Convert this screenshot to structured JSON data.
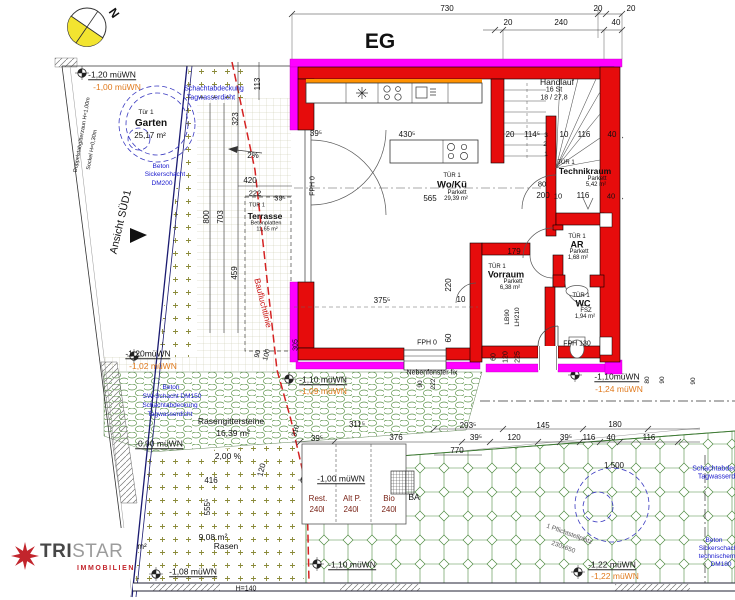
{
  "meta": {
    "title": "EG",
    "north": "N"
  },
  "logo": {
    "tri": "TRI",
    "star": "STAR",
    "sub": "IMMOBILIEN"
  },
  "palette": {
    "wall_red": "#e60c0c",
    "band_magenta": "#ff00ff",
    "accent_orange": "#ff9100",
    "level_orange": "#e07a1e",
    "annotation_blue": "#1818cc",
    "bauflucht_red": "#d42222",
    "pattern_green": "#4d8a40",
    "compass_yellow": "#f2e430",
    "logo_red": "#c2252c"
  },
  "labels": [
    {
      "n": "dim-730",
      "t": "730",
      "x": 447,
      "y": 9
    },
    {
      "n": "dim-20-top-a",
      "t": "20",
      "x": 598,
      "y": 9
    },
    {
      "n": "dim-20-top-b",
      "t": "20",
      "x": 631,
      "y": 9
    },
    {
      "n": "dim-20-top-c",
      "t": "20",
      "x": 508,
      "y": 23
    },
    {
      "n": "dim-240",
      "t": "240",
      "x": 561,
      "y": 23
    },
    {
      "n": "dim-40-top",
      "t": "40",
      "x": 616,
      "y": 23
    },
    {
      "n": "dim-39-entry",
      "t": "39⁵",
      "x": 316,
      "y": 134
    },
    {
      "n": "dim-430",
      "t": "430⁵",
      "x": 407,
      "y": 135
    },
    {
      "n": "dim-20-stair",
      "t": "20",
      "x": 510,
      "y": 135
    },
    {
      "n": "dim-114",
      "t": "114⁵",
      "x": 532,
      "y": 135
    },
    {
      "n": "stair-step-3",
      "t": "3",
      "x": 546,
      "y": 136,
      "fs": 6.5
    },
    {
      "n": "dim-10-stair",
      "t": "10",
      "x": 564,
      "y": 135
    },
    {
      "n": "dim-116-stair",
      "t": "116",
      "x": 584,
      "y": 135
    },
    {
      "n": "dim-40-stair",
      "t": "40",
      "x": 612,
      "y": 135
    },
    {
      "n": "dim-80-tech",
      "t": "80",
      "x": 542,
      "y": 184,
      "fs": 7.5
    },
    {
      "n": "dim-200-tech",
      "t": "200",
      "x": 543,
      "y": 196
    },
    {
      "n": "dim-10-tech",
      "t": "10",
      "x": 558,
      "y": 196,
      "fs": 7.5
    },
    {
      "n": "dim-116-tech",
      "t": "116",
      "x": 583,
      "y": 196
    },
    {
      "n": "dim-40-tech",
      "t": "40",
      "x": 611,
      "y": 196,
      "fs": 7.5
    },
    {
      "n": "stair-step-1",
      "t": "1",
      "x": 546,
      "y": 155,
      "fs": 6.5
    },
    {
      "n": "stair-step-2",
      "t": "2",
      "x": 545,
      "y": 145,
      "fs": 6.5
    },
    {
      "n": "dim-565",
      "t": "565",
      "x": 430,
      "y": 199
    },
    {
      "n": "dim-179",
      "t": "179",
      "x": 514,
      "y": 252
    },
    {
      "n": "dim-220",
      "t": "220",
      "x": 449,
      "y": 285,
      "r": -90
    },
    {
      "n": "dim-375",
      "t": "375⁵",
      "x": 382,
      "y": 301
    },
    {
      "n": "dim-10-wk",
      "t": "10",
      "x": 461,
      "y": 300
    },
    {
      "n": "dim-60-wk",
      "t": "60",
      "x": 449,
      "y": 338,
      "r": -90
    },
    {
      "n": "label-fph0-a",
      "t": "FPH 0",
      "x": 427,
      "y": 343,
      "fs": 7
    },
    {
      "n": "label-fph0-b",
      "t": "FPH 0",
      "x": 313,
      "y": 186,
      "r": -90,
      "fs": 7
    },
    {
      "n": "dim-800",
      "t": "800",
      "x": 207,
      "y": 217,
      "r": -90
    },
    {
      "n": "dim-703",
      "t": "703",
      "x": 221,
      "y": 217,
      "r": -90
    },
    {
      "n": "dim-459",
      "t": "459",
      "x": 235,
      "y": 273,
      "r": -90
    },
    {
      "n": "dim-323",
      "t": "323",
      "x": 236,
      "y": 119,
      "r": -90
    },
    {
      "n": "dim-113",
      "t": "113",
      "x": 258,
      "y": 84,
      "r": -90
    },
    {
      "n": "dim-305",
      "t": "305",
      "x": 296,
      "y": 345,
      "r": -90,
      "fs": 7
    },
    {
      "n": "dim-420",
      "t": "420",
      "x": 250,
      "y": 181
    },
    {
      "n": "dim-222-terr",
      "t": "222",
      "x": 255,
      "y": 193,
      "fs": 7.5
    },
    {
      "n": "dim-39-terr",
      "t": "39⁵",
      "x": 280,
      "y": 198,
      "fs": 7.5
    },
    {
      "n": "dim-90-terr",
      "t": "90",
      "x": 258,
      "y": 354,
      "r": -75,
      "fs": 7
    },
    {
      "n": "dim-100-terr",
      "t": "100",
      "x": 267,
      "y": 355,
      "r": -75,
      "fs": 7
    },
    {
      "n": "dim-60-entry",
      "t": "60",
      "x": 494,
      "y": 357,
      "r": -90,
      "fs": 7
    },
    {
      "n": "dim-120-entry",
      "t": "120",
      "x": 506,
      "y": 357,
      "r": -90,
      "fs": 7
    },
    {
      "n": "dim-225-entry",
      "t": "225",
      "x": 518,
      "y": 357,
      "r": -90,
      "fs": 7
    },
    {
      "n": "label-lb90",
      "t": "LB90",
      "x": 508,
      "y": 317,
      "r": -90,
      "fs": 6.5
    },
    {
      "n": "label-lh210",
      "t": "LH210",
      "x": 518,
      "y": 317,
      "r": -90,
      "fs": 6.5
    },
    {
      "n": "label-fph130",
      "t": "FPH 130",
      "x": 577,
      "y": 344,
      "fs": 7
    },
    {
      "n": "dim-90-window",
      "t": "90",
      "x": 421,
      "y": 384,
      "r": -90,
      "fs": 6.5
    },
    {
      "n": "dim-222-window",
      "t": "222",
      "x": 434,
      "y": 384,
      "r": -90,
      "fs": 6.5
    },
    {
      "n": "dim-80-right",
      "t": "80",
      "x": 648,
      "y": 380,
      "r": -90,
      "fs": 6.5
    },
    {
      "n": "dim-90-right-a",
      "t": "90",
      "x": 663,
      "y": 380,
      "r": -90,
      "fs": 6.5
    },
    {
      "n": "dim-90-right-b",
      "t": "90",
      "x": 694,
      "y": 381,
      "r": -90,
      "fs": 6.5
    },
    {
      "n": "dim-310",
      "t": "310",
      "x": 296,
      "y": 431,
      "r": -75,
      "fs": 7
    },
    {
      "n": "dim-311",
      "t": "311⁵",
      "x": 357,
      "y": 425
    },
    {
      "n": "dim-203",
      "t": "203⁵",
      "x": 468,
      "y": 426
    },
    {
      "n": "dim-145",
      "t": "145",
      "x": 543,
      "y": 426
    },
    {
      "n": "dim-180",
      "t": "180",
      "x": 615,
      "y": 425
    },
    {
      "n": "dim-39-row-a",
      "t": "39⁵",
      "x": 317,
      "y": 439
    },
    {
      "n": "dim-376",
      "t": "376",
      "x": 396,
      "y": 438
    },
    {
      "n": "dim-39-row-b",
      "t": "39⁵",
      "x": 476,
      "y": 438
    },
    {
      "n": "dim-120-row",
      "t": "120",
      "x": 514,
      "y": 438
    },
    {
      "n": "dim-39-row-c",
      "t": "39⁵",
      "x": 566,
      "y": 438
    },
    {
      "n": "dim-116-row-a",
      "t": "116",
      "x": 589,
      "y": 438
    },
    {
      "n": "dim-40-row",
      "t": "40",
      "x": 611,
      "y": 438
    },
    {
      "n": "dim-116-row-b",
      "t": "116",
      "x": 649,
      "y": 438
    },
    {
      "n": "dim-770",
      "t": "770",
      "x": 457,
      "y": 451
    },
    {
      "n": "dim-1500",
      "t": "1 500",
      "x": 614,
      "y": 466
    },
    {
      "n": "dim-416",
      "t": "416",
      "x": 211,
      "y": 481
    },
    {
      "n": "dim-120-lawn",
      "t": "120",
      "x": 262,
      "y": 470,
      "r": -75
    },
    {
      "n": "dim-555",
      "t": "555⁵",
      "x": 208,
      "y": 507,
      "r": -90
    },
    {
      "n": "label-h140",
      "t": "H=140",
      "x": 246,
      "y": 589,
      "fs": 7
    },
    {
      "n": "slope-2pct",
      "t": "2%",
      "x": 253,
      "y": 156
    },
    {
      "n": "slope-200pct",
      "t": "2,00 %",
      "x": 228,
      "y": 456,
      "fs": 8.5
    },
    {
      "n": "room-woku-tuer",
      "t": "TÜR 1",
      "x": 452,
      "y": 176,
      "fs": 6
    },
    {
      "n": "room-woku-name",
      "t": "Wo/Kü",
      "x": 452,
      "y": 185,
      "fs": 9.5,
      "b": 1
    },
    {
      "n": "room-woku-floor",
      "t": "Parkett",
      "x": 457,
      "y": 193,
      "fs": 6
    },
    {
      "n": "room-woku-area",
      "t": "29,39 m²",
      "x": 456,
      "y": 199,
      "fs": 6
    },
    {
      "n": "room-technik-tuer",
      "t": "TÜR 1",
      "x": 566,
      "y": 163,
      "fs": 6
    },
    {
      "n": "room-technik-name",
      "t": "Technikraum",
      "x": 585,
      "y": 171,
      "fs": 8.5,
      "b": 1
    },
    {
      "n": "room-technik-floor",
      "t": "Parkett",
      "x": 597,
      "y": 179,
      "fs": 6
    },
    {
      "n": "room-technik-area",
      "t": "5,42 m²",
      "x": 596,
      "y": 185,
      "fs": 6
    },
    {
      "n": "room-ar-tuer",
      "t": "TÜR 1",
      "x": 577,
      "y": 237,
      "fs": 6
    },
    {
      "n": "room-ar-name",
      "t": "AR",
      "x": 577,
      "y": 245,
      "fs": 9,
      "b": 1
    },
    {
      "n": "room-ar-floor",
      "t": "Parkett",
      "x": 579,
      "y": 252,
      "fs": 6
    },
    {
      "n": "room-ar-area",
      "t": "1,68 m²",
      "x": 578,
      "y": 258,
      "fs": 6
    },
    {
      "n": "room-vorraum-tuer",
      "t": "TÜR 1",
      "x": 497,
      "y": 267,
      "fs": 6
    },
    {
      "n": "room-vorraum-name",
      "t": "Vorraum",
      "x": 506,
      "y": 275,
      "fs": 9,
      "b": 1
    },
    {
      "n": "room-vorraum-floor",
      "t": "Parkett",
      "x": 513,
      "y": 282,
      "fs": 6
    },
    {
      "n": "room-vorraum-area",
      "t": "6,38 m²",
      "x": 510,
      "y": 288,
      "fs": 6
    },
    {
      "n": "room-wc-tuer",
      "t": "TÜR 1",
      "x": 581,
      "y": 296,
      "fs": 6
    },
    {
      "n": "room-wc-name",
      "t": "WC",
      "x": 583,
      "y": 304,
      "fs": 9,
      "b": 1
    },
    {
      "n": "room-wc-floor",
      "t": "FSZ",
      "x": 586,
      "y": 311,
      "fs": 6
    },
    {
      "n": "room-wc-area",
      "t": "1,94 m²",
      "x": 585,
      "y": 317,
      "fs": 6
    },
    {
      "n": "stair-handlauf",
      "t": "Handlauf",
      "x": 557,
      "y": 82,
      "fs": 8.5
    },
    {
      "n": "stair-count",
      "t": "16 St",
      "x": 554,
      "y": 90,
      "fs": 7
    },
    {
      "n": "stair-ratio",
      "t": "18 / 27,8",
      "x": 554,
      "y": 98,
      "fs": 7
    },
    {
      "n": "area-garten-tuer",
      "t": "Tür 1",
      "x": 146,
      "y": 113,
      "fs": 6.5
    },
    {
      "n": "area-garten-name",
      "t": "Garten",
      "x": 151,
      "y": 124,
      "fs": 10,
      "b": 1
    },
    {
      "n": "area-garten-size",
      "t": "25,17 m²",
      "x": 150,
      "y": 136,
      "fs": 8
    },
    {
      "n": "area-terrasse-tuer",
      "t": "TÜR 1",
      "x": 257,
      "y": 206,
      "fs": 5.5
    },
    {
      "n": "area-terrasse-name",
      "t": "Terrasse",
      "x": 265,
      "y": 216,
      "fs": 8.5,
      "b": 1
    },
    {
      "n": "area-terrasse-floor",
      "t": "Betonplatten",
      "x": 266,
      "y": 224,
      "fs": 5.5
    },
    {
      "n": "area-terrasse-size",
      "t": "11,65 m²",
      "x": 267,
      "y": 230,
      "fs": 5.5
    },
    {
      "n": "area-rasengitter-name",
      "t": "Rasengittersteine",
      "x": 231,
      "y": 421,
      "fs": 8.5
    },
    {
      "n": "area-rasengitter-size",
      "t": "16,39 m²",
      "x": 233,
      "y": 433,
      "fs": 8.5
    },
    {
      "n": "area-rasen-size",
      "t": "9,08 m²",
      "x": 213,
      "y": 537,
      "fs": 8.5
    },
    {
      "n": "area-rasen-name",
      "t": "Rasen",
      "x": 226,
      "y": 546,
      "fs": 8.5
    },
    {
      "n": "stray-m2",
      "t": "m²",
      "x": 142,
      "y": 547,
      "fs": 8
    },
    {
      "n": "bin-rest-name",
      "t": "Rest.",
      "x": 318,
      "y": 499,
      "col": "#7a2418"
    },
    {
      "n": "bin-rest-vol",
      "t": "240l",
      "x": 317,
      "y": 510,
      "col": "#7a2418"
    },
    {
      "n": "bin-altp-name",
      "t": "Alt P.",
      "x": 352,
      "y": 499,
      "col": "#7a2418"
    },
    {
      "n": "bin-altp-vol",
      "t": "240l",
      "x": 351,
      "y": 510,
      "col": "#7a2418"
    },
    {
      "n": "bin-bio-name",
      "t": "Bio",
      "x": 389,
      "y": 499,
      "col": "#7a2418"
    },
    {
      "n": "bin-bio-vol",
      "t": "240l",
      "x": 389,
      "y": 510,
      "col": "#7a2418"
    },
    {
      "n": "label-ba",
      "t": "BA",
      "x": 414,
      "y": 497,
      "fs": 8.5
    },
    {
      "n": "stellplatz-line1",
      "t": "1 Pflichtstellplatz",
      "x": 569,
      "y": 535,
      "fs": 6.5,
      "col": "#555555",
      "r": 20
    },
    {
      "n": "stellplatz-line2",
      "t": "230x650",
      "x": 563,
      "y": 548,
      "fs": 6.5,
      "col": "#555555",
      "r": 20
    },
    {
      "n": "schacht-tl-1",
      "t": "Schachtabdeckung",
      "x": 214,
      "y": 89,
      "fs": 7,
      "col": "#1818cc"
    },
    {
      "n": "schacht-tl-2",
      "t": "Tagwasserdicht",
      "x": 211,
      "y": 98,
      "fs": 7,
      "col": "#1818cc"
    },
    {
      "n": "sicker-tl-1",
      "t": "Beton",
      "x": 161,
      "y": 167,
      "fs": 6.5,
      "col": "#1818cc"
    },
    {
      "n": "sicker-tl-2",
      "t": "Sickerschacht",
      "x": 165,
      "y": 175,
      "fs": 6.5,
      "col": "#1818cc"
    },
    {
      "n": "sicker-tl-3",
      "t": "DM200",
      "x": 162,
      "y": 184,
      "fs": 6.5,
      "col": "#1818cc"
    },
    {
      "n": "sw-schacht-1",
      "t": "Beton",
      "x": 171,
      "y": 388,
      "fs": 6.5,
      "col": "#1818cc"
    },
    {
      "n": "sw-schacht-2",
      "t": "SW-Schacht DM150",
      "x": 172,
      "y": 397,
      "fs": 6.5,
      "col": "#1818cc"
    },
    {
      "n": "sw-schacht-3",
      "t": "Schachtabdeckung",
      "x": 170,
      "y": 406,
      "fs": 6.5,
      "col": "#1818cc"
    },
    {
      "n": "sw-schacht-4",
      "t": "Tagwasserdicht",
      "x": 170,
      "y": 415,
      "fs": 6.5,
      "col": "#1818cc"
    },
    {
      "n": "schacht-br-1",
      "t": "Schachtabdeckung",
      "x": 722,
      "y": 469,
      "fs": 7,
      "col": "#1818cc"
    },
    {
      "n": "schacht-br-2",
      "t": "Tagwasserdicht",
      "x": 722,
      "y": 477,
      "fs": 7,
      "col": "#1818cc"
    },
    {
      "n": "sicker-br-1",
      "t": "Beton",
      "x": 714,
      "y": 541,
      "fs": 6.5,
      "col": "#1818cc"
    },
    {
      "n": "sicker-br-2",
      "t": "Sickerschacht",
      "x": 719,
      "y": 549,
      "fs": 6.5,
      "col": "#1818cc"
    },
    {
      "n": "sicker-br-3",
      "t": "technischem",
      "x": 717,
      "y": 557,
      "fs": 6.5,
      "col": "#1818cc"
    },
    {
      "n": "sicker-br-4",
      "t": "DM180",
      "x": 721,
      "y": 565,
      "fs": 6.5,
      "col": "#1818cc"
    },
    {
      "n": "label-nebenfenster",
      "t": "Nebenfenster fix",
      "x": 432,
      "y": 373,
      "fs": 7
    },
    {
      "n": "level-garten-main",
      "t": "-1,20 müWN",
      "x": 112,
      "y": 75,
      "fs": 8.5,
      "u": 1
    },
    {
      "n": "level-mid-main",
      "t": "-1,20müWN",
      "x": 148,
      "y": 354,
      "fs": 8.5,
      "u": 1
    },
    {
      "n": "level-low-main",
      "t": "-0,90 müWN",
      "x": 159,
      "y": 444,
      "fs": 8.5,
      "u": 1
    },
    {
      "n": "level-terr-main",
      "t": "-1,10 müWN",
      "x": 323,
      "y": 380,
      "fs": 8.5,
      "u": 1
    },
    {
      "n": "level-right-main",
      "t": "-1,10müWN",
      "x": 617,
      "y": 377,
      "fs": 8.5,
      "u": 1
    },
    {
      "n": "level-bins-main",
      "t": "-1,00 müWN",
      "x": 341,
      "y": 479,
      "fs": 8.5,
      "u": 1
    },
    {
      "n": "level-bottom-main",
      "t": "-1,10 müWN",
      "x": 352,
      "y": 565,
      "fs": 8.5,
      "u": 1
    },
    {
      "n": "level-rasen-main",
      "t": "-1,08 müWN",
      "x": 193,
      "y": 572,
      "fs": 8.5,
      "u": 1
    },
    {
      "n": "level-br-main",
      "t": "-1,22 müWN",
      "x": 612,
      "y": 565,
      "fs": 8.5,
      "u": 1
    },
    {
      "n": "level-garten-alt",
      "t": "-1,00 müWN",
      "x": 117,
      "y": 87,
      "fs": 8.5,
      "col": "#e07a1e"
    },
    {
      "n": "level-mid-alt",
      "t": "-1,02 müWN",
      "x": 153,
      "y": 366,
      "fs": 8.5,
      "col": "#e07a1e"
    },
    {
      "n": "level-terr-alt",
      "t": "-1,09 müWN",
      "x": 323,
      "y": 391,
      "fs": 8.5,
      "col": "#e07a1e"
    },
    {
      "n": "level-right-alt",
      "t": "-1,24 müWN",
      "x": 619,
      "y": 389,
      "fs": 8.5,
      "col": "#e07a1e"
    },
    {
      "n": "level-br-alt",
      "t": "-1,22 müWN",
      "x": 615,
      "y": 576,
      "fs": 8.5,
      "col": "#e07a1e"
    },
    {
      "n": "label-baufluchtlinie",
      "t": "Baufluchtlinie",
      "x": 263,
      "y": 303,
      "fs": 8.5,
      "col": "#cc1616",
      "r": 76
    },
    {
      "n": "fence-label-1",
      "t": "Doppelstabgitterzaun H=1,00m",
      "x": 83,
      "y": 135,
      "fs": 5.5,
      "r": -80
    },
    {
      "n": "fence-label-2",
      "t": "Sockel H=0,30m",
      "x": 93,
      "y": 150,
      "fs": 5.5,
      "r": -80
    },
    {
      "n": "label-ansicht-sued",
      "t": "Ansicht SÜD1",
      "x": 121,
      "y": 222,
      "fs": 10.5,
      "r": -77
    }
  ]
}
